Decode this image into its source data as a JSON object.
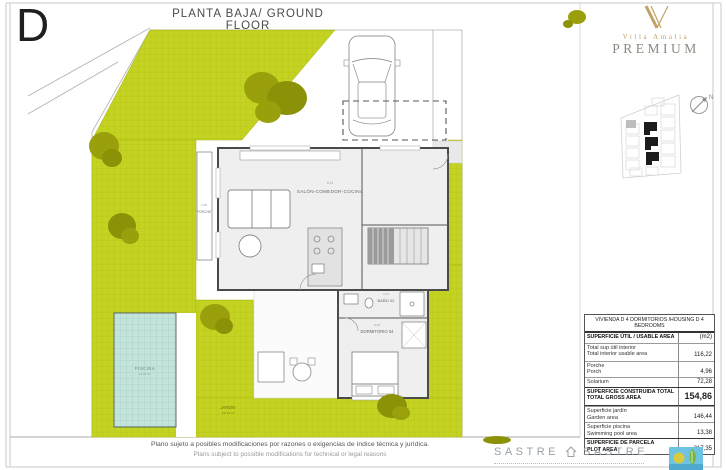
{
  "page": {
    "variant_letter": "D",
    "title": "PLANTA BAJA/ GROUND FLOOR"
  },
  "brand": {
    "name": "Villa Amalia",
    "tier": "PREMIUM"
  },
  "compass": {
    "north_label": "N"
  },
  "plan": {
    "labels": {
      "salon": "SALÓN-COMEDOR-COCINA",
      "bano": "BAÑO 02",
      "dormitorio": "DORMITORIO 04",
      "porche": "PORCHE",
      "piscina": "PISCINA",
      "jardin": "JARDÍN"
    },
    "dims": {
      "salon": "6,11",
      "bano": "2,21",
      "dormitorio": "9,40",
      "porche": "1,95",
      "piscina": "13,38 m2",
      "jardin": "146,44 m2"
    },
    "colors": {
      "garden": "#c4d321",
      "garden_grid": "#b5c31a",
      "tree_light": "#9aa00b",
      "tree_dark": "#8c9208",
      "pool": "#c3e4da",
      "pool_grid": "#a4cfc2",
      "wall": "#4a4a4a",
      "gold": "#c2a264",
      "logo_blue": "#6ec2e2",
      "logo_yellow": "#d9ca3e",
      "logo_green": "#76b43e"
    }
  },
  "table": {
    "header": "VIVIENDA D 4 DORMITORIOS /HOUSING D 4 BEDROOMS",
    "rows": [
      {
        "label_es": "SUPERFICIE ÚTIL / USABLE AREA",
        "label_en": "",
        "value": "(m2)"
      },
      {
        "label_es": "Total sup útil interior",
        "label_en": "Total interior usable area",
        "value": "116,22"
      },
      {
        "label_es": "Porche",
        "label_en": "Porch",
        "value": "4,96"
      },
      {
        "label_es": "Solarium",
        "label_en": "",
        "value": "72,28"
      },
      {
        "label_es": "SUPERFICIE CONSTRUIDA TOTAL",
        "label_en": "TOTAL GROSS AREA",
        "value": "154,86"
      },
      {
        "label_es": "Superficie jardín",
        "label_en": "Garden area",
        "value": "146,44"
      },
      {
        "label_es": "Superficie piscina",
        "label_en": "Swimming pool area",
        "value": "13,38"
      },
      {
        "label_es": "SUPERFICIE DE PARCELA",
        "label_en": "PLOT AREA",
        "value": "217,35"
      }
    ]
  },
  "footer": {
    "disclaimer_es": "Plano sujeto a posibles modificaciones por razones o exigencias de índice técnica y jurídica.",
    "disclaimer_en": "Plans subject to possible modifications for technical or legal reasons",
    "sastre_left": "SASTRE",
    "sastre_right": "SASTRE"
  }
}
